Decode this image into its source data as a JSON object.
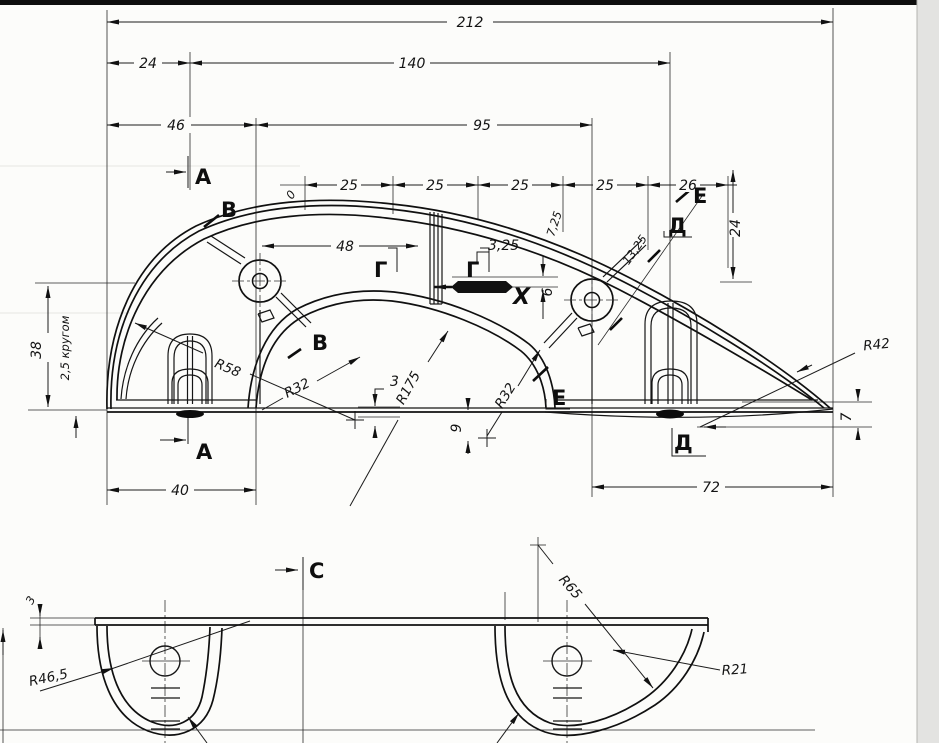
{
  "tv": {
    "d212": "212",
    "d140": "140",
    "d24": "24",
    "d46": "46",
    "d95": "95",
    "p1": "25",
    "p2": "25",
    "p3": "25",
    "p4": "25",
    "p5": "26",
    "zero": "0",
    "d48": "48",
    "d325": "3,25",
    "d725": "7,25",
    "d1325": "13,25",
    "d24v": "24",
    "d38": "38",
    "wall": "2,5 кругом",
    "d6": "6",
    "d9": "9",
    "d3": "3",
    "d7": "7",
    "d40": "40",
    "d72": "72",
    "r58": "R58",
    "r32a": "R32",
    "r175": "R175",
    "r32b": "R32",
    "r42": "R42",
    "sa1": "А",
    "sa2": "А",
    "sb1": "В",
    "sb2": "В",
    "sg1": "Г",
    "sg2": "Г",
    "sd1": "Д",
    "sd2": "Д",
    "se1": "Е",
    "se2": "Е",
    "sx": "Х"
  },
  "bv": {
    "sc": "С",
    "r465": "R46,5",
    "r65": "R65",
    "r21": "R21",
    "d3": "3"
  }
}
